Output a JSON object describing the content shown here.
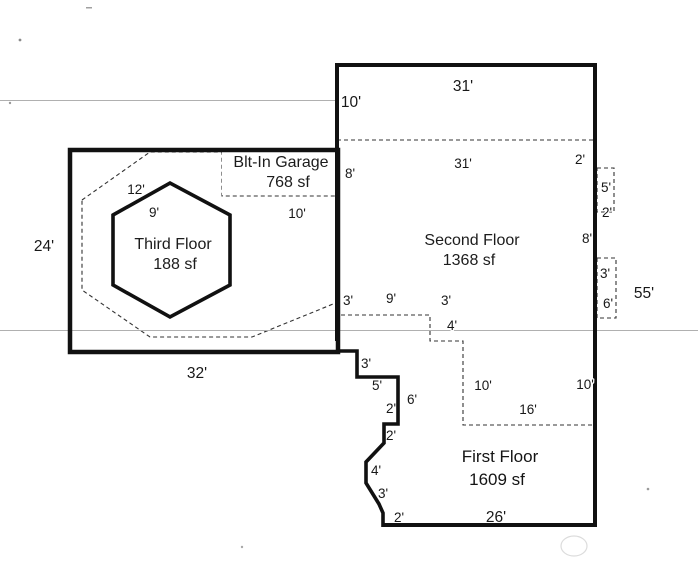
{
  "sketch": {
    "floors": {
      "garage": {
        "label": "Blt-In Garage",
        "area": "768 sf"
      },
      "third": {
        "label": "Third Floor",
        "area": "188 sf"
      },
      "second": {
        "label": "Second Floor",
        "area": "1368 sf"
      },
      "first": {
        "label": "First Floor",
        "area": "1609 sf"
      }
    },
    "dims": {
      "top_width": "31'",
      "upper_left_side": "10'",
      "second_top_width": "31'",
      "second_top_right": "2'",
      "second_left_top": "8'",
      "garage_band": "10'",
      "garage_left_side": "24'",
      "garage_bottom": "32'",
      "hex_top": "12'",
      "hex_inner": "9'",
      "bump1_a": "5'",
      "bump1_b": "2'",
      "right_mid": "8'",
      "bump2_a": "3'",
      "bump2_b": "6'",
      "right_total": "55'",
      "second_bottom_a": "3'",
      "second_bottom_b": "9'",
      "second_bottom_c": "3'",
      "notch": "4'",
      "stair_a": "3'",
      "stair_b": "5'",
      "stair_c": "2'",
      "stair_side": "6'",
      "stair_d": "2'",
      "stair_e": "4'",
      "stair_f": "3'",
      "stair_g": "2'",
      "first_bottom": "26'",
      "ext_left": "10'",
      "ext_right": "10'",
      "ext_bottom": "16'"
    },
    "colors": {
      "ink": "#111111",
      "paper": "#ffffff",
      "hatch": "#262626",
      "faint": "#b0b0b0"
    }
  }
}
